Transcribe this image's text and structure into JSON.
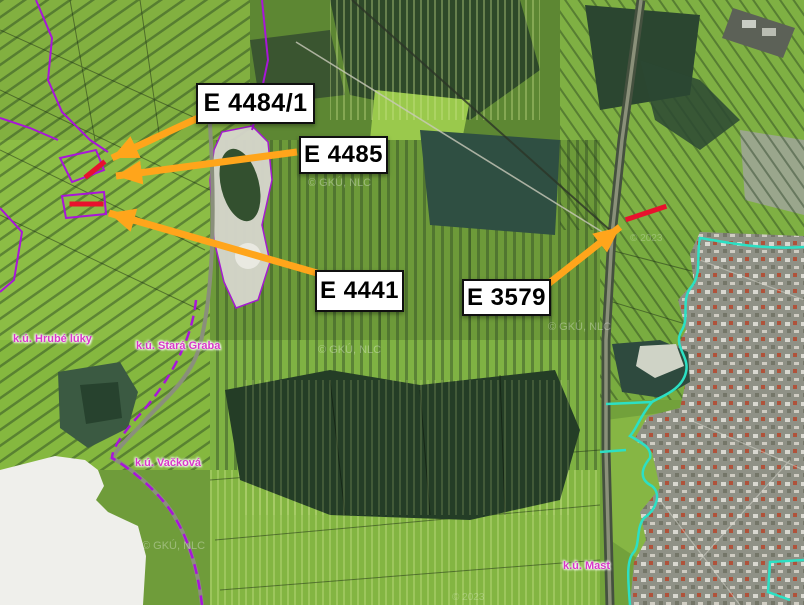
{
  "map": {
    "attribution_watermark": "© GKÚ, NLC",
    "year_watermark": "© 2023",
    "cadastre_labels": [
      {
        "id": "hrube-luky",
        "text": "k.ú. Hrubé lúky"
      },
      {
        "id": "stara-graba",
        "text": "k.ú. Stará Graba"
      },
      {
        "id": "vackova",
        "text": "k.ú. Vačková"
      },
      {
        "id": "mast",
        "text": "k.ú. Mast"
      }
    ]
  },
  "annotations": {
    "parcel_labels": [
      {
        "id": "e-4484-1",
        "text": "E 4484/1"
      },
      {
        "id": "e-4485",
        "text": "E 4485"
      },
      {
        "id": "e-4441",
        "text": "E 4441"
      },
      {
        "id": "e-3579",
        "text": "E 3579"
      }
    ]
  },
  "colors": {
    "arrow_orange": "#FFA51B",
    "marker_red": "#E8112D",
    "cadastre_magenta": "#D837C8",
    "boundary_purple": "#A816D8",
    "town_boundary_cyan": "#2CE0C4",
    "label_box_bg": "#FFFFFF",
    "label_box_border": "#101010"
  }
}
